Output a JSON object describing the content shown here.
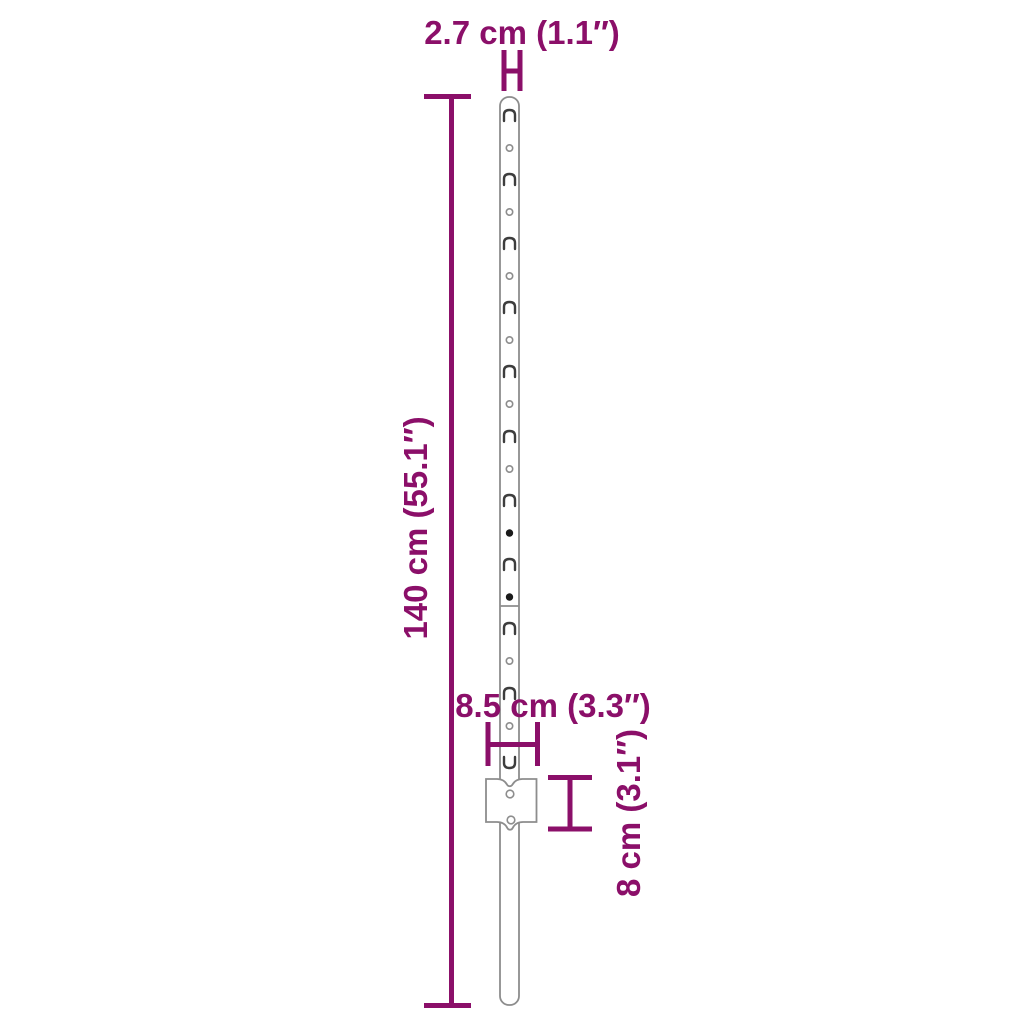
{
  "product": {
    "type": "dimension-diagram",
    "subject": "metal u-post fence post with anchor plate"
  },
  "colors": {
    "accent": "#8B0F69",
    "outline": "#8d8d8d",
    "slot": "#3d3d3d",
    "fastener_fill": "#1a1a1a",
    "background": "#ffffff"
  },
  "labels": {
    "post_width": "2.7 cm (1.1″)",
    "post_height": "140 cm (55.1″)",
    "anchor_width": "8.5 cm (3.3″)",
    "anchor_height": "8 cm (3.1″)"
  }
}
